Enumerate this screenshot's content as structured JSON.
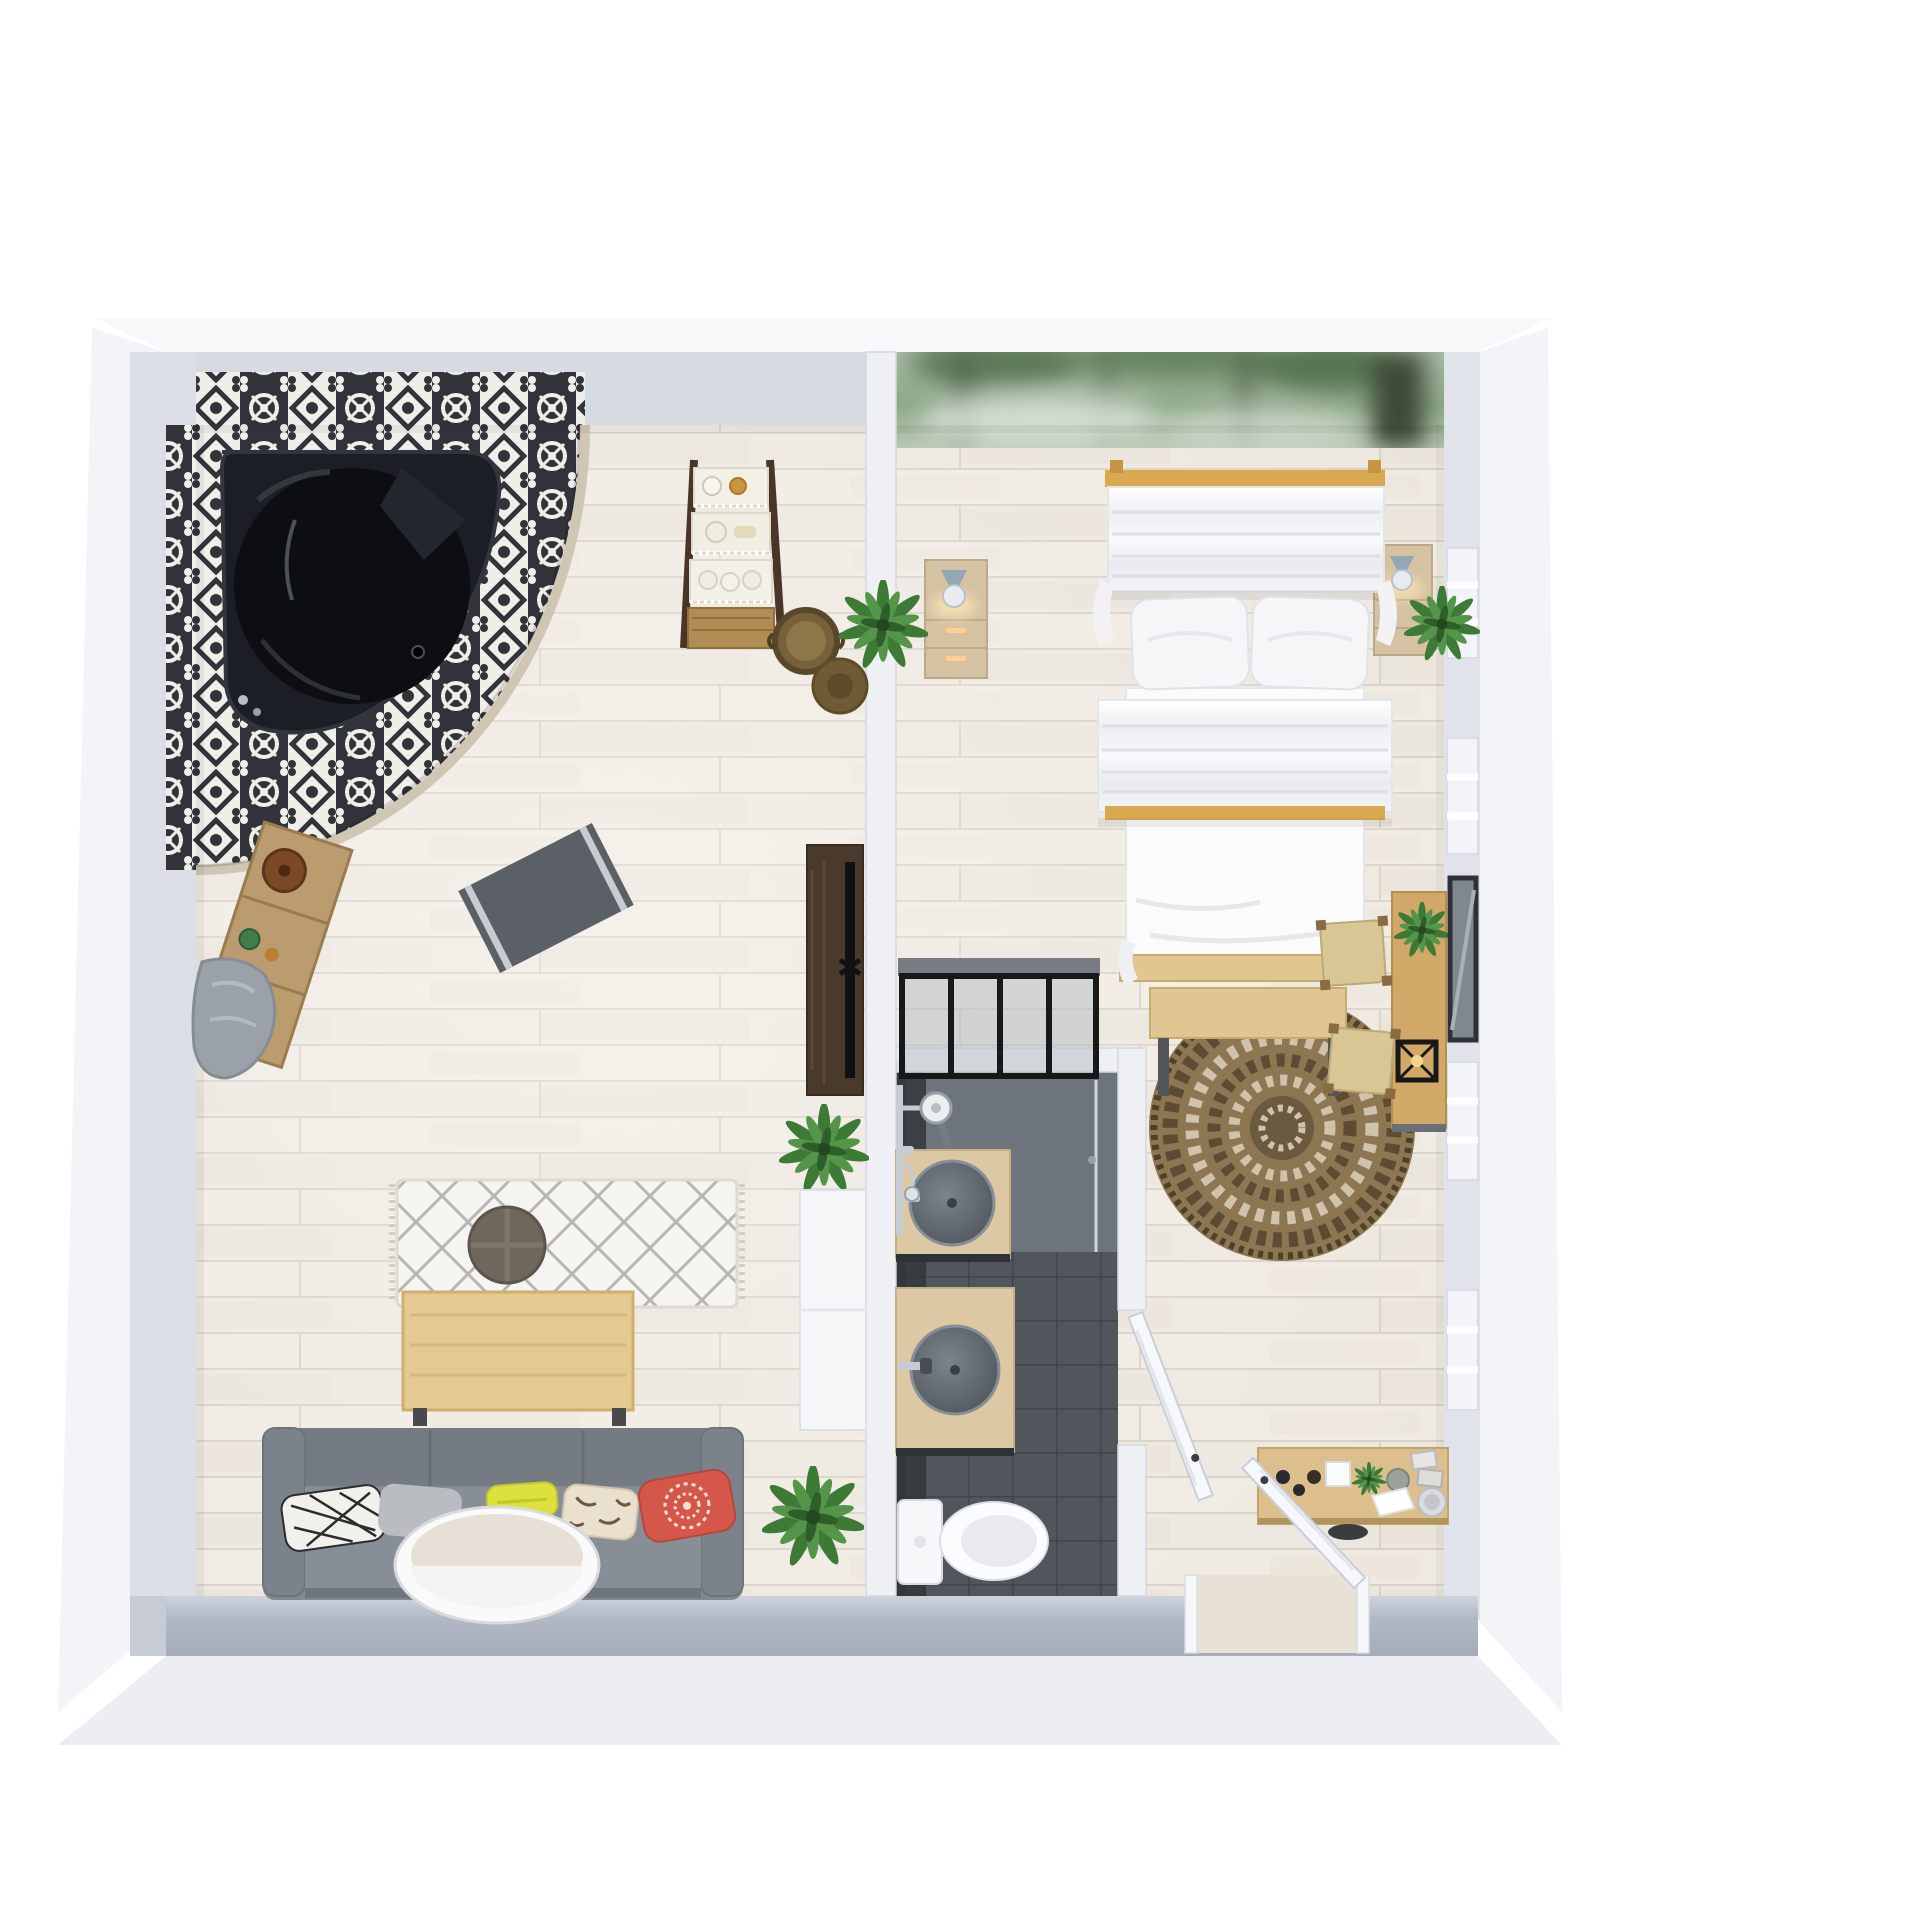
{
  "scene": {
    "kind": "3d-floor-plan-render",
    "view": "top-down isometric",
    "background": "#ffffff",
    "rooms": [
      "lounge-with-jacuzzi",
      "bedroom",
      "bathroom"
    ]
  },
  "palette": {
    "background": "#ffffff",
    "floor_wood": "#ece7de",
    "floor_seam": "#d8d1c5",
    "wall_face": "#d6dae1",
    "wall_flare": "#f5f6f9",
    "wall_bottom": "#a9afbc",
    "tile_dark": "#33343a",
    "tile_light": "#efeee9",
    "tub_black": "#16181d",
    "bath_floor": "#565b61",
    "shower_floor": "#6e747b",
    "vanity_wood": "#dcc9a4",
    "basin_gray": "#60666d",
    "sofa_gray": "#81888f",
    "pillow_yellow": "#dde13e",
    "pillow_red": "#d4574a",
    "pillow_beige": "#e9e1cd",
    "wood_light": "#e4ca90",
    "wood_mid": "#d2a868",
    "wood_dark": "#4a3a2c",
    "jute_brown": "#8d7752",
    "plant_green": "#4c8c42",
    "mural_green": "#8da888",
    "canopy_white": "#f7f8fa",
    "chrome": "#c7ccd2"
  },
  "inventory": {
    "lounge": [
      "corner-jacuzzi-tub",
      "tiled-platform",
      "tile-wainscot",
      "bath-caddy-shelf",
      "bathrobe",
      "bath-mat",
      "ladder-shelf-with-baskets",
      "laundry-basket",
      "sun-hat",
      "tv-cabinet",
      "tv",
      "potted-plants",
      "white-storage-cabinet",
      "diamond-pattern-rug",
      "pouf",
      "wood-coffee-table",
      "gray-sofa",
      "throw-pillows",
      "oval-coffee-table"
    ],
    "bedroom": [
      "forest-mural-wall",
      "canopy-bed",
      "bed-pillows",
      "nightstands",
      "table-lamps",
      "potted-plants",
      "foot-bench",
      "round-jute-rug",
      "desk",
      "stools",
      "candle-lantern",
      "wall-mirror",
      "console-table",
      "decor-bottles-books-plates",
      "louvered-windows"
    ],
    "bathroom": [
      "black-frame-glass-partition",
      "shower-set",
      "wood-vanity-counters",
      "round-stone-basins",
      "toilet",
      "dark-tile-floor",
      "white-door-bathroom",
      "white-door-entry"
    ]
  }
}
